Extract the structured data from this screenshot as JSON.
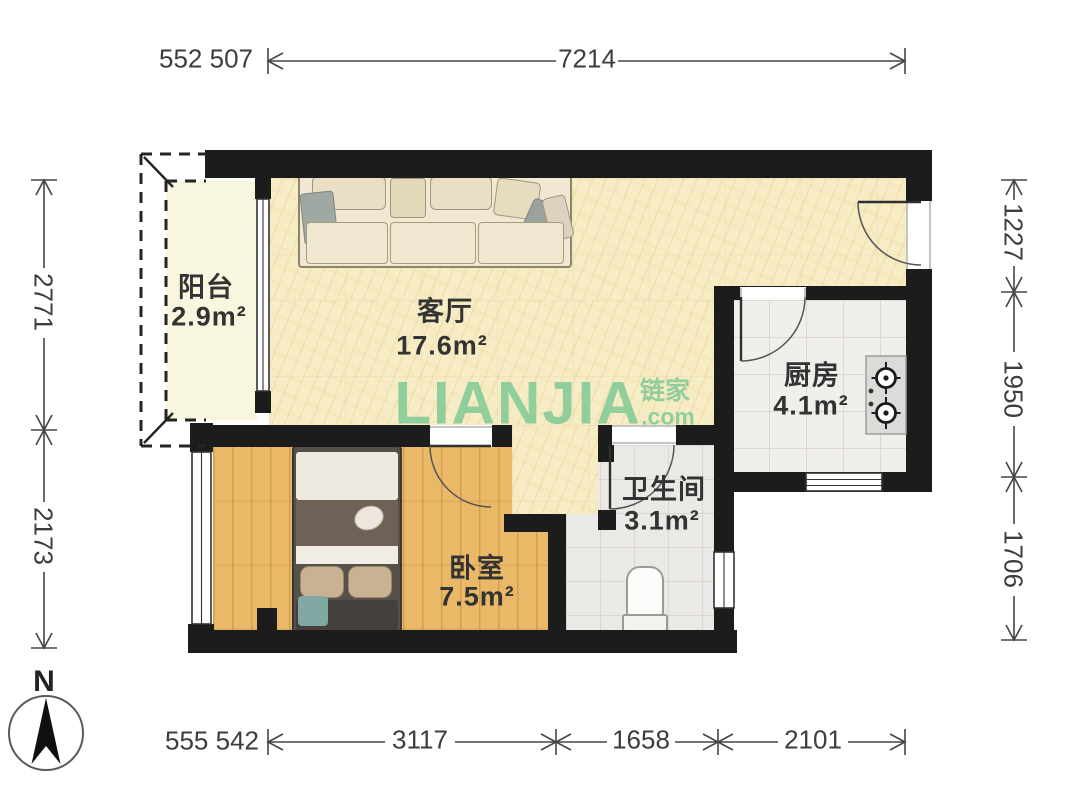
{
  "rooms": {
    "balcony": {
      "name": "阳台",
      "area": "2.9m²"
    },
    "living": {
      "name": "客厅",
      "area": "17.6m²"
    },
    "kitchen": {
      "name": "厨房",
      "area": "4.1m²"
    },
    "bathroom": {
      "name": "卫生间",
      "area": "3.1m²"
    },
    "bedroom": {
      "name": "卧室",
      "area": "7.5m²"
    }
  },
  "dimensions": {
    "top_prefix": "552 507",
    "top": "7214",
    "left_upper": "2771",
    "left_lower": "2173",
    "right_upper": "1227",
    "right_middle": "1950",
    "right_lower": "1706",
    "bottom_prefix": "555 542",
    "bottom_left": "3117",
    "bottom_middle": "1658",
    "bottom_right": "2101"
  },
  "compass": {
    "north": "N"
  },
  "watermark": {
    "brand": "LIANJIA",
    "cn": "链家",
    "tld": ".com"
  },
  "colors": {
    "wall": "#1c1c1c",
    "living_floor": "#f6ecc5",
    "bedroom_floor": "#e9b968",
    "kitchen_floor": "#f0efeb",
    "bathroom_floor": "#eae9e5",
    "balcony_floor": "#f9f6df",
    "brand_green": "#8ccd9b"
  }
}
